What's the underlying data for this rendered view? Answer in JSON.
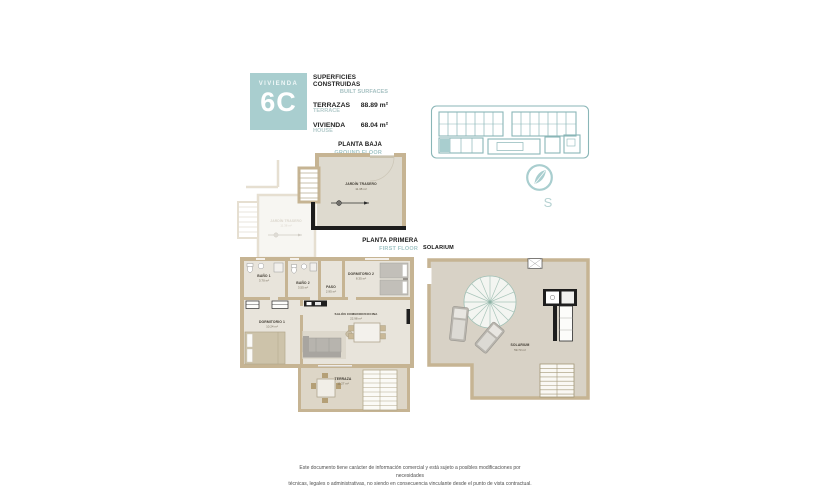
{
  "colors": {
    "accent_teal": "#a9cecf",
    "teal_text": "#a3c6c7",
    "wall_tan": "#c6b493",
    "black_wall": "#1c1c1c"
  },
  "header": {
    "unit_label": "VIVIENDA",
    "unit_number": "6C",
    "surfaces_title": "SUPERFICIES CONSTRUIDAS",
    "surfaces_subtitle": "BUILT SURFACES",
    "rows": [
      {
        "name": "TERRAZAS",
        "name_en": "TERRACE",
        "value": "88.89 m²"
      },
      {
        "name": "VIVIENDA",
        "name_en": "HOUSE",
        "value": "68.04 m²"
      }
    ]
  },
  "compass": {
    "south": "S"
  },
  "ground_floor": {
    "title": "PLANTA BAJA",
    "subtitle": "GROUND FLOOR",
    "garden": {
      "name": "JARDÍN TRASERO",
      "area": "11.38 m²"
    },
    "neighbor_garden": {
      "name": "JARDÍN TRASERO",
      "area": "11.38 m²"
    }
  },
  "first_floor": {
    "title": "PLANTA PRIMERA",
    "subtitle": "FIRST FLOOR",
    "rooms": {
      "bath1": {
        "name": "BAÑO 1",
        "area": "3.70 m²"
      },
      "bath2": {
        "name": "BAÑO 2",
        "area": "3.55 m²"
      },
      "hall": {
        "name": "PASO",
        "area": "2.95 m²"
      },
      "bedroom2": {
        "name": "DORMITORIO 2",
        "area": "8.35 m²"
      },
      "bedroom1": {
        "name": "DORMITORIO 1",
        "area": "10.24 m²"
      },
      "living": {
        "name": "SALÓN COMEDOR/COCINA",
        "area": "22.98 m²"
      },
      "terrace": {
        "name": "TERRAZA",
        "area": "11.27 m²"
      }
    }
  },
  "solarium_floor": {
    "title": "SOLARIUM",
    "room": {
      "name": "SOLARIUM",
      "area": "59.73 m²"
    }
  },
  "footer": {
    "line1": "Este documento tiene carácter de información comercial y está sujeto a posibles modificaciones por necesidades",
    "line2": "técnicas, legales o administrativas, no siendo en consecuencia vinculante desde el punto de vista contractual."
  }
}
